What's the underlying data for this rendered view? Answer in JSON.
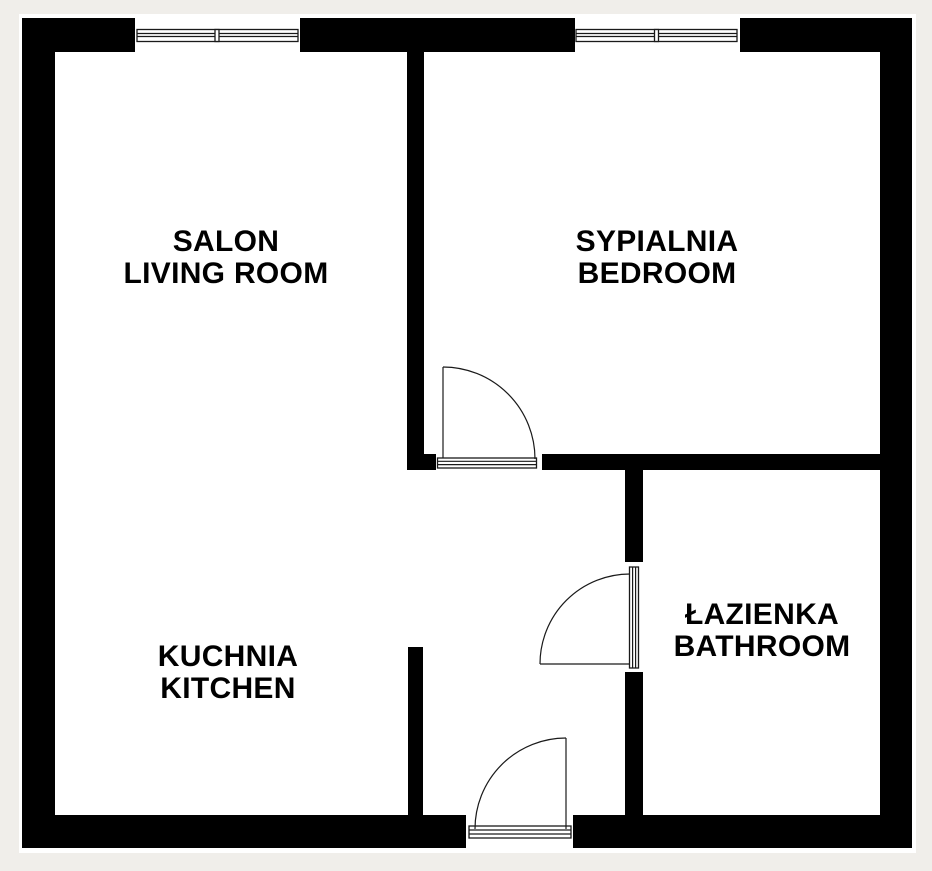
{
  "plan": {
    "type": "floor-plan",
    "colors": {
      "background": "#f0eeea",
      "wall": "#000000",
      "floor": "#ffffff",
      "line": "#1a1a1a",
      "text": "#000000"
    },
    "rooms": [
      {
        "id": "living-room",
        "line1": "SALON",
        "line2": "LIVING ROOM"
      },
      {
        "id": "bedroom",
        "line1": "SYPIALNIA",
        "line2": "BEDROOM"
      },
      {
        "id": "kitchen",
        "line1": "KUCHNIA",
        "line2": "KITCHEN"
      },
      {
        "id": "bathroom",
        "line1": "ŁAZIENKA",
        "line2": "BATHROOM"
      }
    ],
    "windows": [
      {
        "id": "living-room-window",
        "wall": "top",
        "panes": 2
      },
      {
        "id": "bedroom-window",
        "wall": "top",
        "panes": 2
      }
    ],
    "doors": [
      {
        "id": "bedroom-door",
        "connects": "hall-to-bedroom",
        "swing": "into-bedroom"
      },
      {
        "id": "bathroom-door",
        "connects": "hall-to-bathroom",
        "swing": "into-hall"
      },
      {
        "id": "entrance-door",
        "connects": "outside-to-hall",
        "swing": "into-hall",
        "wall": "bottom"
      }
    ]
  }
}
